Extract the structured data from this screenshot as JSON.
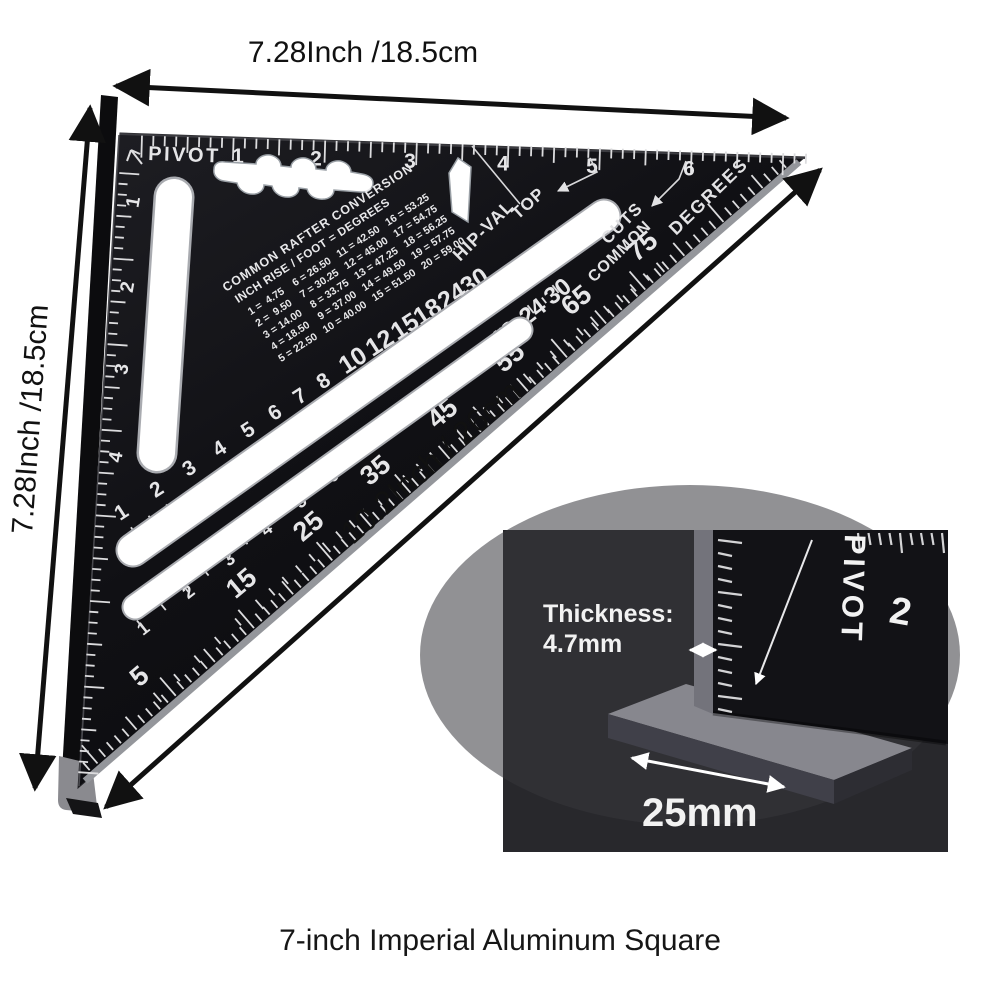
{
  "caption": "7-inch Imperial Aluminum Square",
  "dimensions": {
    "top": "7.28Inch /18.5cm",
    "left": "7.28Inch /18.5cm",
    "hypotenuse": "10.2Inch / 26cm"
  },
  "square": {
    "pivot_label": "PIVOT",
    "top_ruler": {
      "values": [
        "1",
        "2",
        "3",
        "4",
        "5",
        "6"
      ]
    },
    "left_ruler": {
      "values": [
        "1",
        "2",
        "3",
        "4"
      ]
    },
    "rafter_table": {
      "title": "COMMON RAFTER CONVERSION",
      "header": "INCH RISE / FOOT = DEGREES",
      "rows": [
        "1 =  4.75    6 = 26.50   11 = 42.50   16 = 53.25",
        "2 =  9.50    7 = 30.25   12 = 45.00   17 = 54.75",
        "3 = 14.00    8 = 33.75   13 = 47.25   18 = 56.25",
        "4 = 18.50    9 = 37.00   14 = 49.50   19 = 57.75",
        "5 = 22.50   10 = 40.00   15 = 51.50   20 = 59.00"
      ]
    },
    "labels": {
      "hip_val": "HIP-VAL",
      "top": "TOP",
      "cuts": "CUTS",
      "common": "COMMON",
      "degrees": "DEGREES"
    },
    "scales": {
      "hip_val_row": {
        "values": [
          "1",
          "2",
          "3",
          "4",
          "5",
          "6",
          "7",
          "8",
          "10",
          "12",
          "15",
          "18",
          "24",
          "30"
        ]
      },
      "common_row": {
        "values": [
          "1",
          "2",
          "3",
          "4",
          "5",
          "6",
          "7",
          "8",
          "10",
          "12",
          "15",
          "18",
          "24",
          "30"
        ]
      },
      "degrees_row": {
        "values": [
          "5",
          "15",
          "25",
          "35",
          "45",
          "55",
          "65",
          "75"
        ]
      }
    }
  },
  "inset": {
    "thickness_label": "Thickness:",
    "thickness_value": "4.7mm",
    "width_value": "25mm",
    "pivot_label": "PIVOT",
    "ruler_number": "2"
  },
  "colors": {
    "square_black": "#101014",
    "marking_white": "#e6e6e8",
    "bevel_gray": "#94969b",
    "flange_black": "#0c0c0e",
    "tip_gray": "#8a8a8f",
    "inset_bg": "#28282c",
    "metal_light": "#87878e",
    "metal_mid": "#404049",
    "arrow_black": "#111111",
    "caption_black": "#161616",
    "background": "#ffffff"
  }
}
